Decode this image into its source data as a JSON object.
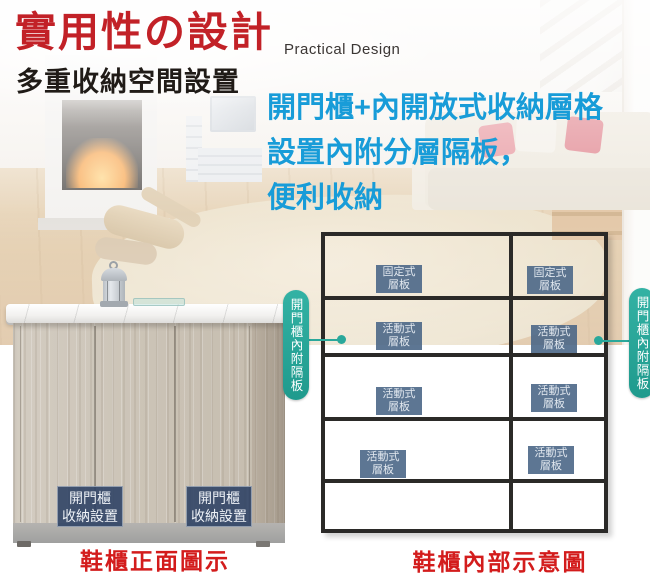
{
  "header": {
    "title": "實用性の設計",
    "subtitle_en": "Practical Design",
    "tagline": "多重收納空間設置"
  },
  "description": {
    "line1": "開門櫃+內開放式收納層格",
    "line2": "設置內附分層隔板，",
    "line3": "便利收納"
  },
  "front_figure": {
    "door_label_line1": "開門櫃",
    "door_label_line2": "收納設置",
    "caption": "鞋櫃正面圖示"
  },
  "diagram": {
    "side_label": "開門櫃內附隔板",
    "caption": "鞋櫃內部示意圖",
    "shelf_labels": [
      {
        "line1": "固定式",
        "line2": "層板"
      },
      {
        "line1": "固定式",
        "line2": "層板"
      },
      {
        "line1": "活動式",
        "line2": "層板"
      },
      {
        "line1": "活動式",
        "line2": "層板"
      },
      {
        "line1": "活動式",
        "line2": "層板"
      },
      {
        "line1": "活動式",
        "line2": "層板"
      },
      {
        "line1": "活動式",
        "line2": "層板"
      },
      {
        "line1": "活動式",
        "line2": "層板"
      }
    ]
  },
  "colors": {
    "title_red": "#c22127",
    "caption_red": "#d31c1c",
    "description_blue": "#189cd8",
    "teal_accent": "#2aa89b",
    "shelf_label_bg": "#4b6787",
    "door_label_bg": "#2b4063",
    "grid_line": "#2b2a28"
  }
}
